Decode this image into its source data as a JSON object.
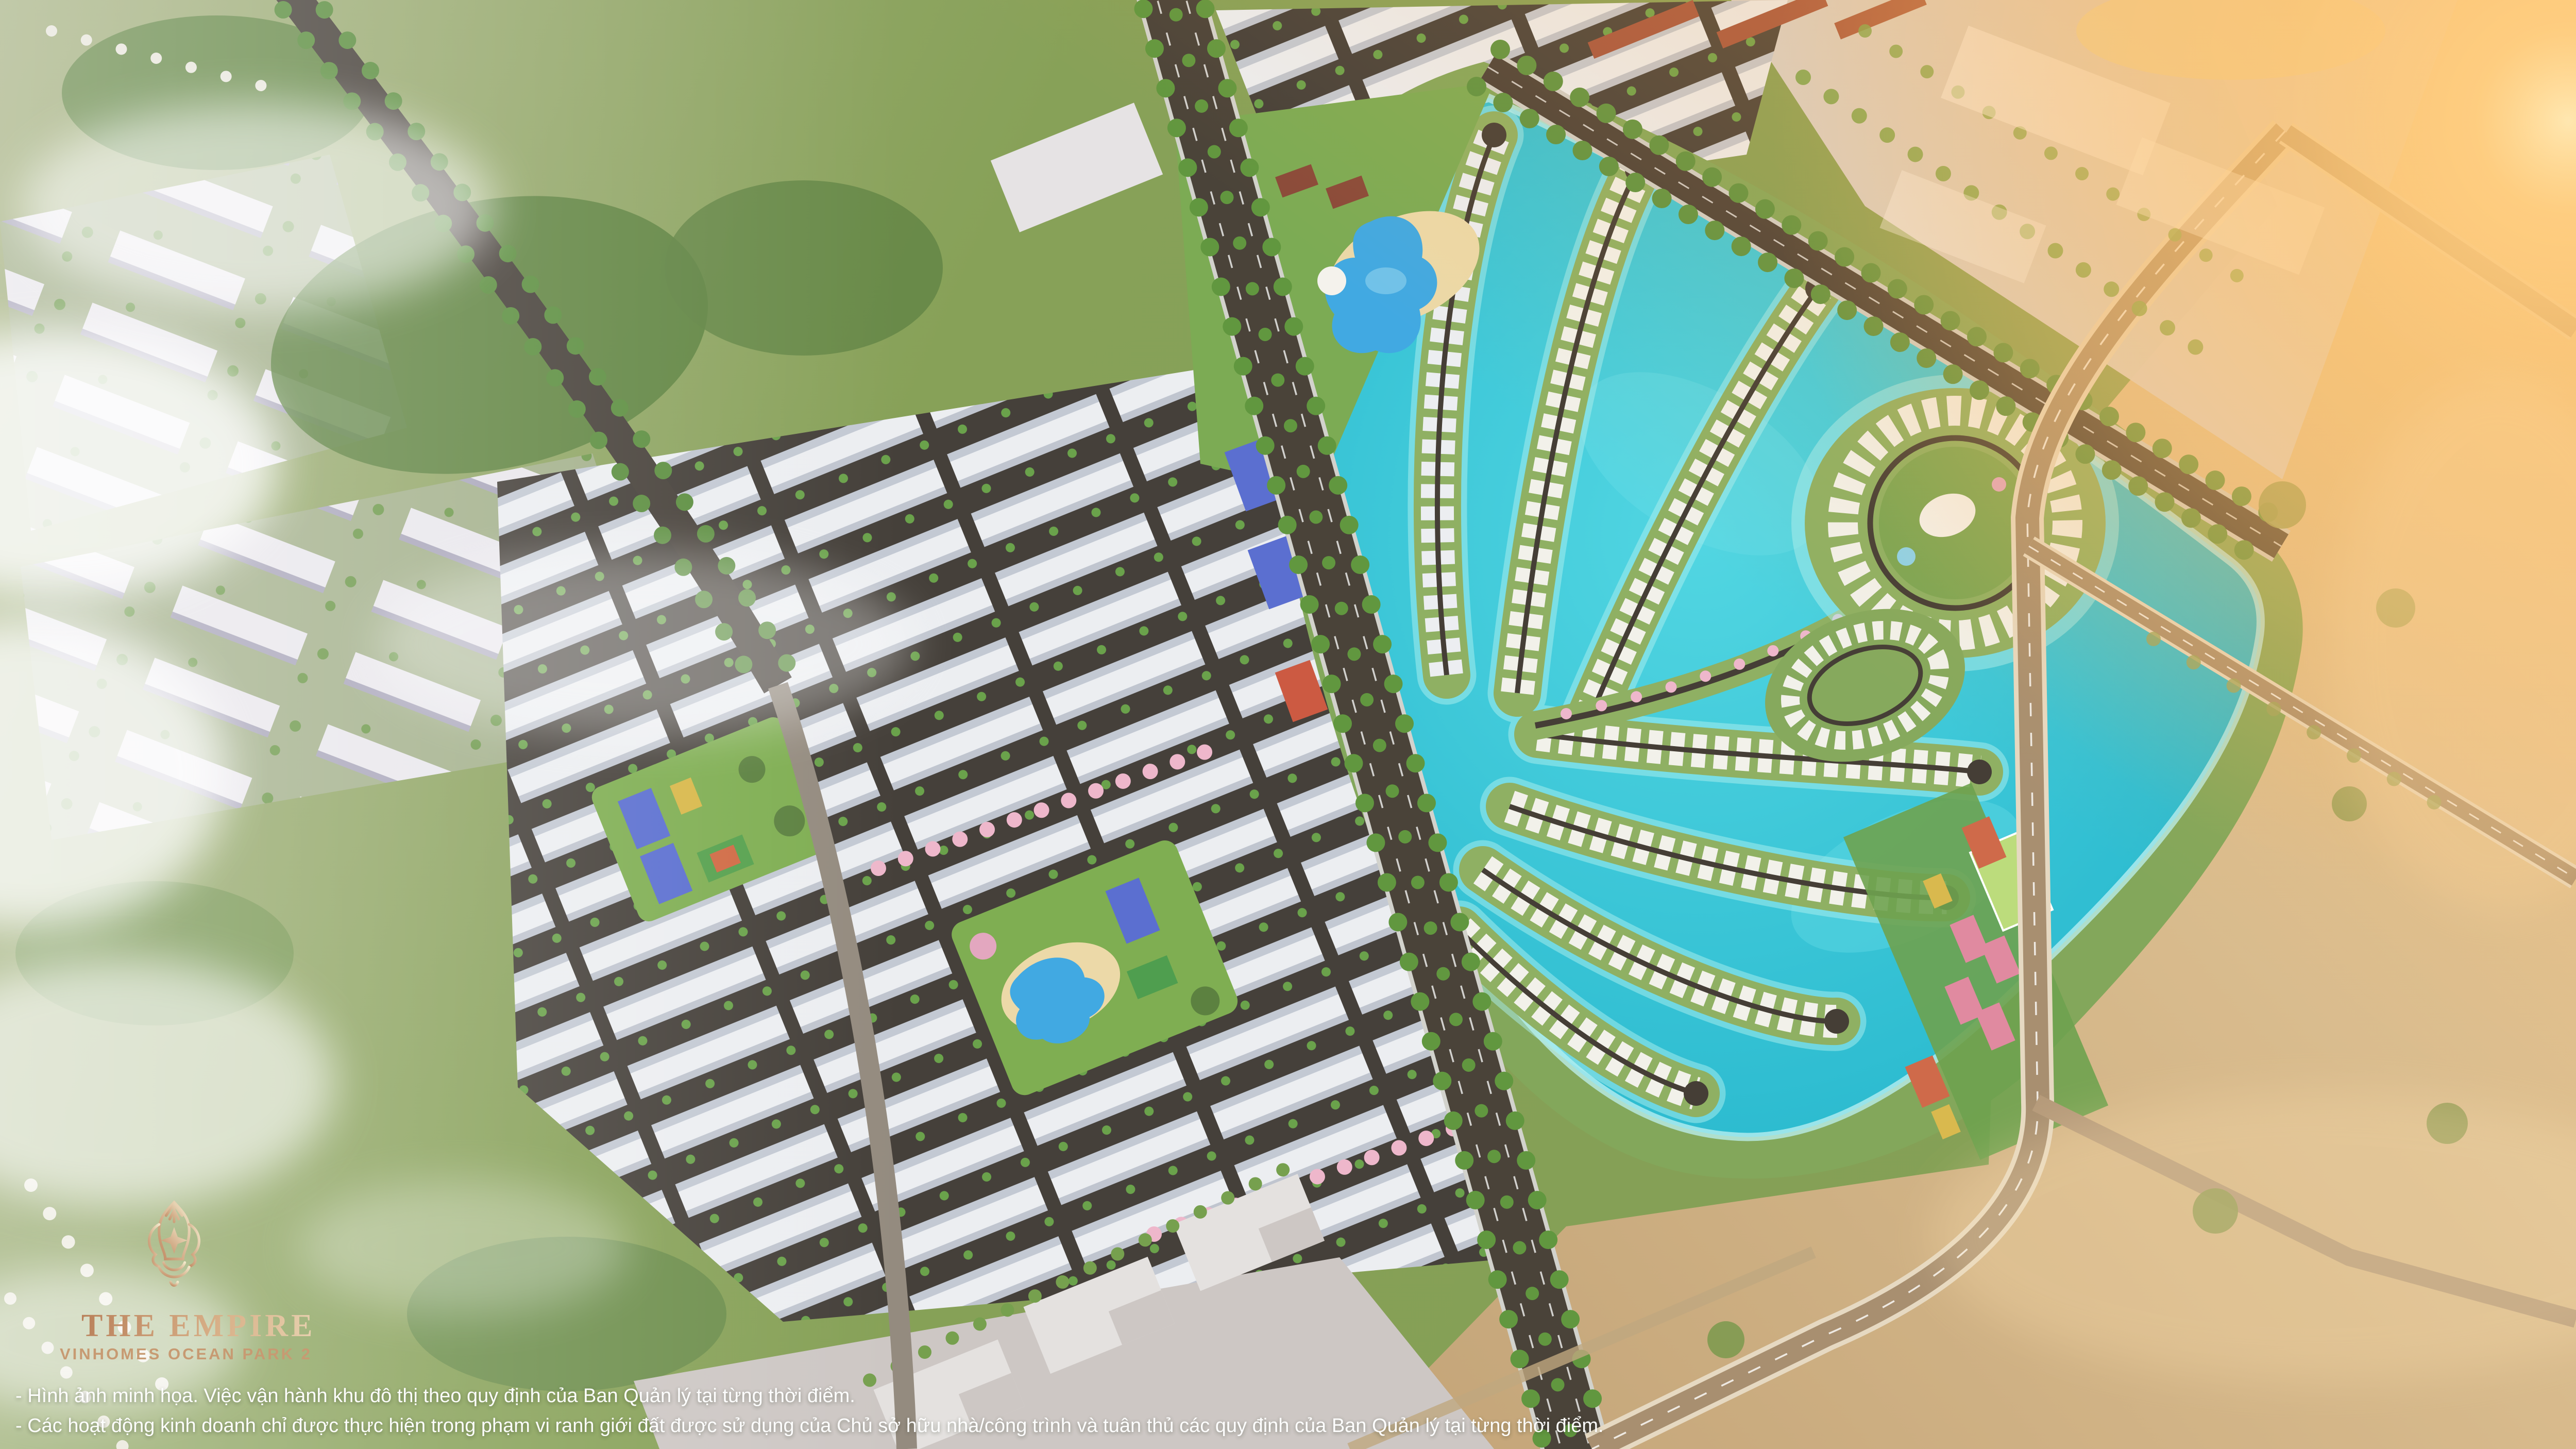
{
  "logo": {
    "emblem_icon": "royal-vase-crest-icon",
    "title": "THE EMPIRE",
    "subtitle": "VINHOMES OCEAN PARK 2"
  },
  "disclaimer": {
    "line1": "- Hình ảnh minh họa. Việc vận hành khu đô thị theo quy định của Ban Quản lý tại từng thời điểm.",
    "line2": "- Các hoạt động kinh doanh chỉ được thực hiện trong phạm vi ranh giới đất được sử dụng của Chủ sở hữu nhà/công trình và tuân thủ các quy định của Ban Quản lý tại từng thời điểm."
  },
  "palette": {
    "base_green": "#84a055",
    "shore_green": "#83a75b",
    "lagoon_deep": "#22b4cb",
    "lagoon_light": "#52d6e2",
    "lagoon_glow": "#bdf2f3",
    "district_ground": "#45403a",
    "roof_white": "#eceef1",
    "road_dark": "#4a4339",
    "beige_land": "#c3a478",
    "beige_light": "#ecd0a0",
    "pavement": "#dcd5d2",
    "flare_orange": "#ffb659",
    "court_blue": "#5b6fd0",
    "court_pink": "#e08aa0",
    "court_orange": "#cf6a4a",
    "field_green": "#bcdc7c",
    "blossom_pink": "#eeb7cb",
    "cloud_white": "#ffffff",
    "logo_gold_from": "#b9805a",
    "logo_gold_to": "#f2e7c9",
    "subtitle_gold": "#c79a72",
    "disclaimer_white": "#ffffff"
  },
  "scene": {
    "landmarks": [
      "palm-leaf-lagoon",
      "villa-peninsulas",
      "island-villa-ring",
      "rowhouse-grid-district",
      "central-avenue",
      "waterpark-pool",
      "sports-courts-strip",
      "apartment-blocks-west",
      "sunlit-fields-east",
      "clouds-west",
      "sun-flare-northeast"
    ]
  }
}
